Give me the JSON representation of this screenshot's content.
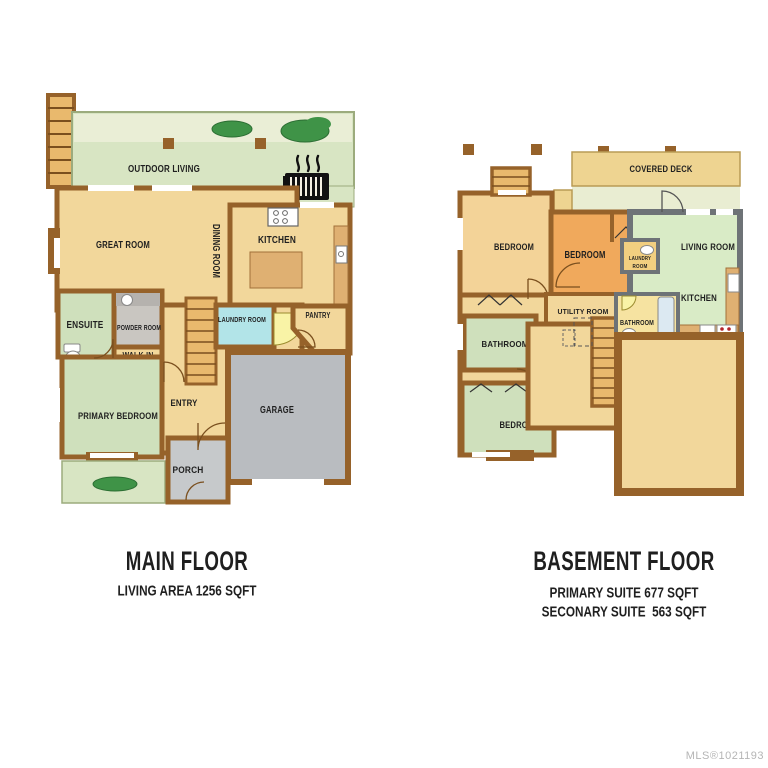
{
  "colors": {
    "wall": "#96622a",
    "wall_gray": "#6e7377",
    "floor_tan": "#f2d79b",
    "floor_tan2": "#f3d398",
    "floor_orange": "#f0a95c",
    "floor_green": "#cfe0bc",
    "floor_mint": "#d9ebc6",
    "floor_cyan": "#b2e4e8",
    "garage_gray": "#b9bcc0",
    "porch_gray": "#c6c9cb",
    "powder_gray": "#c9c6c1",
    "outdoor": "#d8e5c3",
    "outdoor_light": "#eaeed6",
    "deck": "#eed491",
    "patio": "#e9edd2",
    "bath_yellow": "#f6e3a1",
    "laundry_gold": "#f2cf80",
    "stair": "#e9b96d",
    "counter": "#dfb072",
    "bush": "#3f9347",
    "door_yellow": "#f9f3a6",
    "text": "#1f1f1f",
    "watermark": "#b5b5b5"
  },
  "main_floor": {
    "title": "MAIN FLOOR",
    "subtitle": "LIVING AREA 1256 SQFT",
    "labels": {
      "outdoor_living": "OUTDOOR LIVING",
      "great_room": "GREAT ROOM",
      "dining_room": "DINING ROOM",
      "kitchen": "KITCHEN",
      "ensuite": "ENSUITE",
      "powder_room": "POWDER ROOM",
      "walkin_line1": "WALK-IN",
      "walkin_line2": "CLOSET",
      "laundry_room": "LAUNDRY ROOM",
      "pantry": "PANTRY",
      "primary_bedroom": "PRIMARY BEDROOM",
      "entry": "ENTRY",
      "garage": "GARAGE",
      "porch": "PORCH"
    }
  },
  "basement_floor": {
    "title": "BASEMENT FLOOR",
    "subtitle_primary": "PRIMARY SUITE 677 SQFT",
    "subtitle_secondary": "SECONARY SUITE  563 SQFT",
    "labels": {
      "covered_deck": "COVERED DECK",
      "bedroom_left": "BEDROOM",
      "bedroom_middle": "BEDROOM",
      "laundry_line1": "LAUNDRY",
      "laundry_line2": "ROOM",
      "living_room": "LIVING ROOM",
      "kitchen": "KITCHEN",
      "utility_room": "UTILITY ROOM",
      "bathroom_middle": "BATHROOM",
      "bathroom_left": "BATHROOM",
      "bedroom_lower": "BEDROOM"
    }
  },
  "watermark": {
    "text": "MLS®1021193"
  }
}
